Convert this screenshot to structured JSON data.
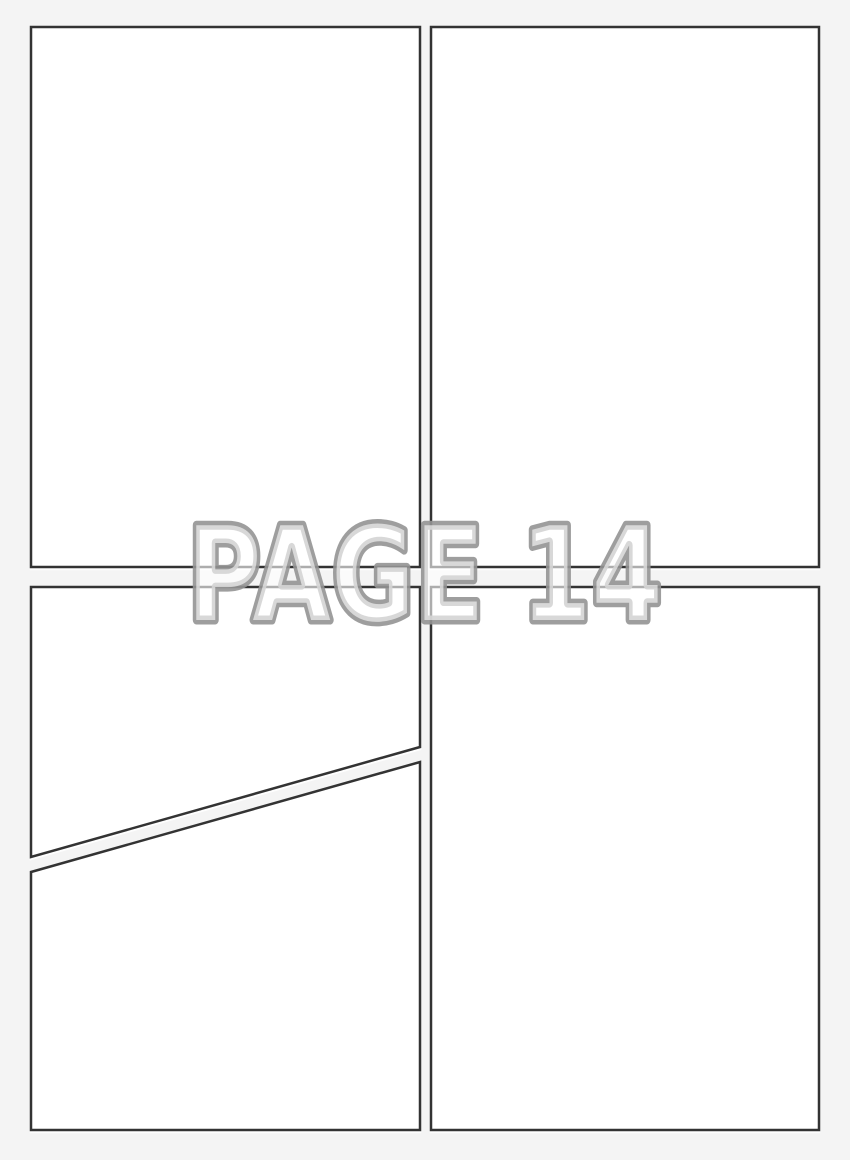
{
  "page_label": {
    "text": "PAGE 14"
  },
  "panels": {
    "count": 5,
    "items": [
      {
        "name": "top-left",
        "shape": "rectangle"
      },
      {
        "name": "top-right",
        "shape": "rectangle"
      },
      {
        "name": "bottom-left-upper",
        "shape": "diagonal-cut"
      },
      {
        "name": "bottom-left-lower",
        "shape": "diagonal-cut"
      },
      {
        "name": "bottom-right",
        "shape": "rectangle"
      }
    ]
  },
  "colors": {
    "background": "#f4f4f4",
    "panel_fill": "#ffffff",
    "panel_border": "#333333",
    "label_outline": "#949494",
    "label_fill": "rgba(255,255,255,0.6)"
  }
}
